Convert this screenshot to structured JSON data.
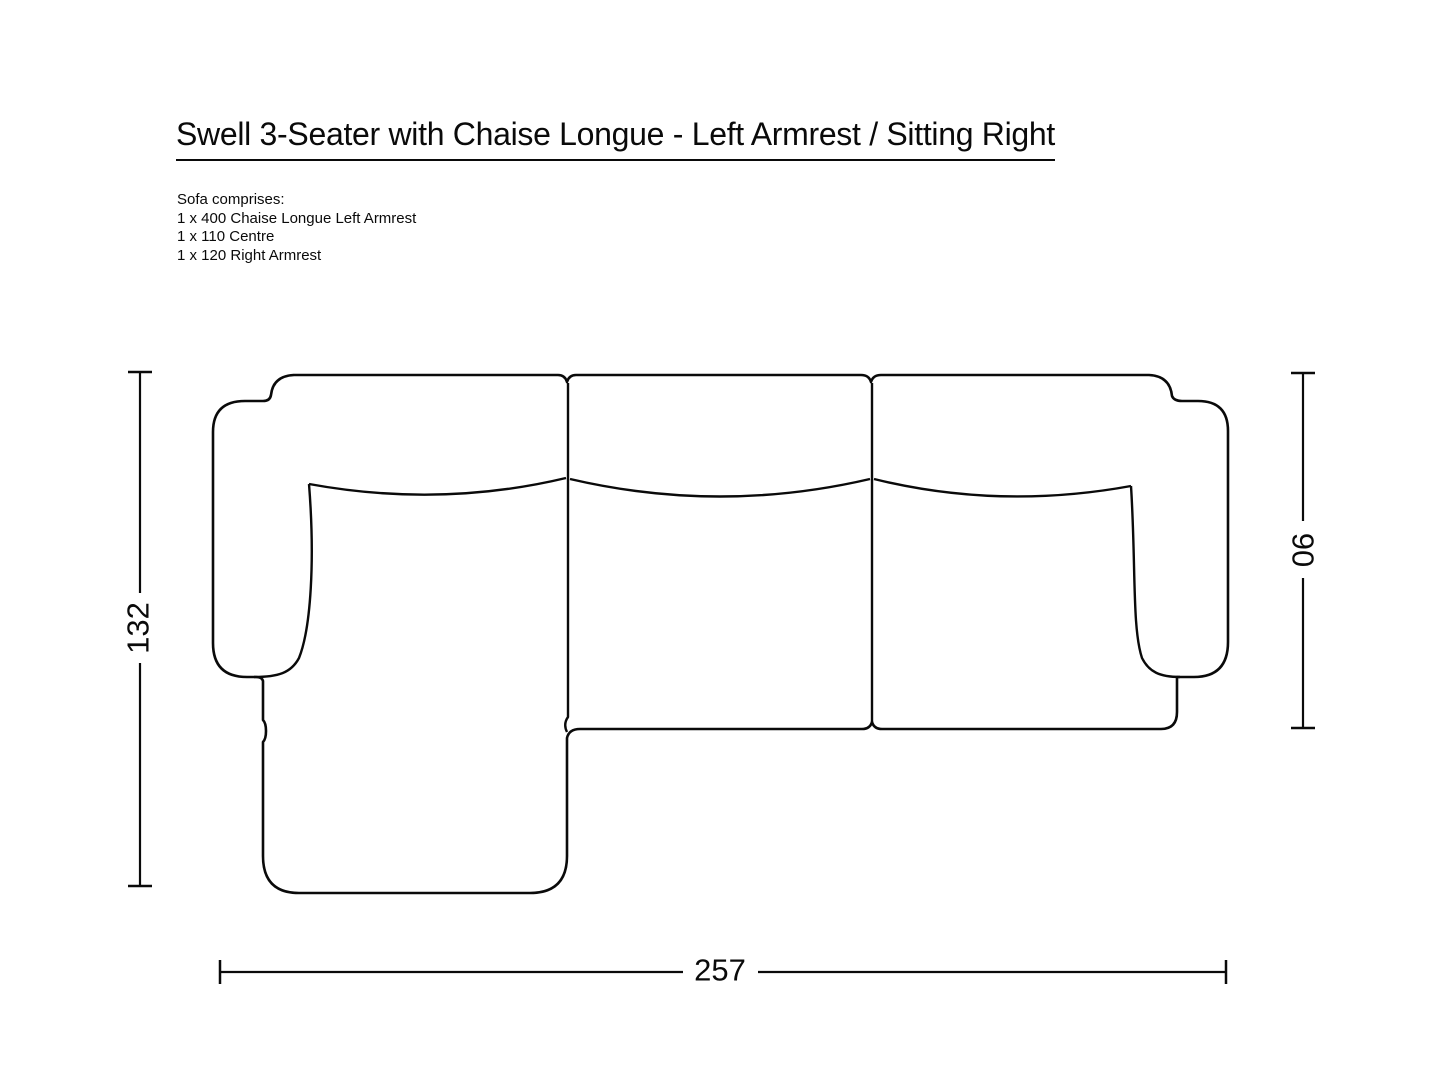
{
  "title": "Swell 3-Seater with Chaise Longue - Left Armrest / Sitting Right",
  "description": {
    "intro": "Sofa comprises:",
    "items": [
      "1 x 400 Chaise Longue Left Armrest",
      "1 x 110 Centre",
      "1 x 120 Right Armrest"
    ]
  },
  "diagram": {
    "type": "sofa-top-view-technical-drawing",
    "dimensions": {
      "overall_width_cm": "257",
      "overall_depth_cm": "132",
      "sofa_depth_cm": "90"
    }
  },
  "colors": {
    "line": "#0a0a0a",
    "background": "#ffffff"
  }
}
